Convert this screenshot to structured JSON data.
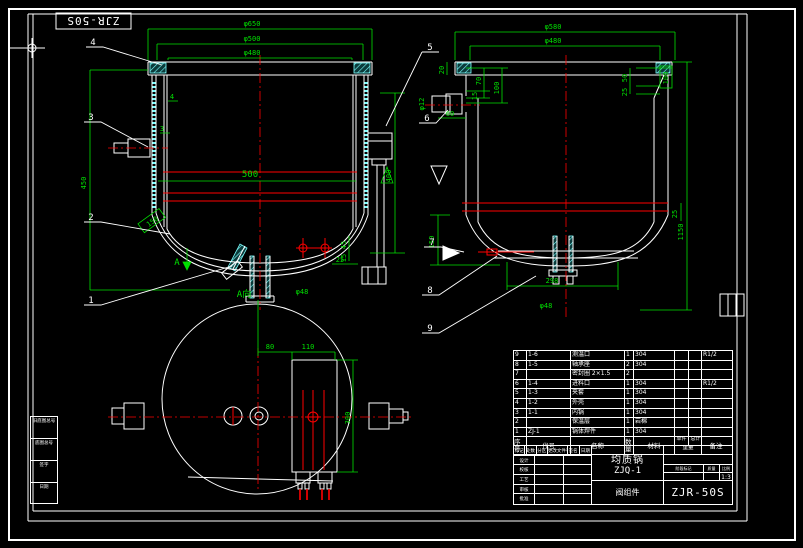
{
  "colors": {
    "dim_green": "#00e000",
    "line_white": "#ffffff",
    "centerline_red": "#ff0000",
    "hatch_cyan": "#7dffff"
  },
  "sheet": {
    "corner_label": "ZJR-50S"
  },
  "balloons": [
    "1",
    "2",
    "3",
    "4",
    "5",
    "6",
    "7",
    "8",
    "9"
  ],
  "front_view": {
    "dims": {
      "d1": "φ650",
      "d2": "φ500",
      "d3": "φ480",
      "d500": "500",
      "d450": "450",
      "d400": "400",
      "t4": "4",
      "t3": "3",
      "d45": "45",
      "d15": "15",
      "d25": "25",
      "d150": "150",
      "dphi48": "φ48",
      "arrow": "A"
    }
  },
  "side_view": {
    "dims": {
      "d1": "φ580",
      "d2": "φ480",
      "d20": "20",
      "d70": "70",
      "d100": "100",
      "d15": "15",
      "d50": "50",
      "d25": "25",
      "dbox100": "100",
      "d1150": "1150",
      "d150": "150",
      "d298": "298",
      "d25b": "25",
      "dphi48": "φ48",
      "dphi12": "φ12",
      "d60": "60"
    }
  },
  "bottom_view": {
    "label": "A向",
    "dims": {
      "d80": "80",
      "d110": "110",
      "d300": "300"
    }
  },
  "parts_list": {
    "headers": {
      "no": "序号",
      "code": "代号",
      "name": "名称",
      "qty": "数量",
      "material": "材料",
      "unit": "单件",
      "total": "总计",
      "weight": "重量",
      "remark": "备注"
    },
    "rows": [
      {
        "no": "9",
        "code": "1-6",
        "name": "测温口",
        "qty": "1",
        "material": "304",
        "unit": "",
        "total": "",
        "remark": "R1/2"
      },
      {
        "no": "8",
        "code": "1-5",
        "name": "轴承座",
        "qty": "2",
        "material": "304",
        "unit": "",
        "total": "",
        "remark": ""
      },
      {
        "no": "7",
        "code": "",
        "name": "密封圈 2×1.5",
        "qty": "2",
        "material": "",
        "unit": "",
        "total": "",
        "remark": ""
      },
      {
        "no": "6",
        "code": "1-4",
        "name": "进料口",
        "qty": "1",
        "material": "304",
        "unit": "",
        "total": "",
        "remark": "R1/2"
      },
      {
        "no": "5",
        "code": "1-3",
        "name": "夹套",
        "qty": "1",
        "material": "304",
        "unit": "",
        "total": "",
        "remark": ""
      },
      {
        "no": "4",
        "code": "1-2",
        "name": "外壳",
        "qty": "1",
        "material": "304",
        "unit": "",
        "total": "",
        "remark": ""
      },
      {
        "no": "3",
        "code": "1-1",
        "name": "内锅",
        "qty": "1",
        "material": "304",
        "unit": "",
        "total": "",
        "remark": ""
      },
      {
        "no": "2",
        "code": "",
        "name": "保温层",
        "qty": "1",
        "material": "岩棉",
        "unit": "",
        "total": "",
        "remark": ""
      },
      {
        "no": "1",
        "code": "ZJ-1",
        "name": "锅体焊件",
        "qty": "1",
        "material": "304",
        "unit": "",
        "total": "",
        "remark": ""
      }
    ]
  },
  "title_block": {
    "product": "均质锅",
    "model": "ZJQ-1",
    "part": "阀组件",
    "drawing_no": "ZJR-50S",
    "scale": "1:3",
    "rev_header": [
      "标记",
      "处数",
      "分区",
      "更改文件号",
      "签名",
      "日期"
    ],
    "sign_rows": [
      "设计",
      "校核",
      "工艺",
      "审核",
      "批准"
    ],
    "stage_labels": [
      "阶段标记",
      "质量",
      "比例"
    ]
  },
  "margin_boxes": [
    "旧底图总号",
    "底图总号",
    "签字",
    "日期"
  ]
}
